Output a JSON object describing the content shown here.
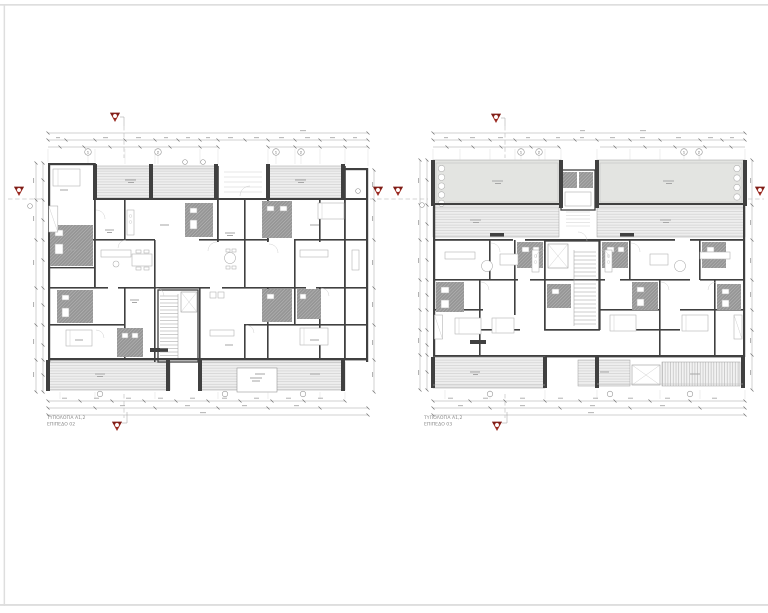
{
  "sheet": {
    "background_color": "#ffffff",
    "border_color": "#dedede"
  },
  "drawing": {
    "type": "architectural-floor-plans",
    "colors": {
      "wall": "#404040",
      "line_light": "#9c9c9c",
      "wet_area_fill": "#969696",
      "balcony_fill": "#eeeeee",
      "terrace_fill": "#e3e4e1",
      "section_marker_red": "#9b2b22"
    },
    "plans": [
      {
        "title": "ΤΥΠΟΛΟΓΙΑ A1,2",
        "level": "ΕΠΙΠΕΔΟ 02",
        "grid_bubbles": [
          "1",
          "2",
          "1",
          "2"
        ]
      },
      {
        "title": "ΤΥΠΟΛΟΓΙΑ A1,2",
        "level": "ΕΠΙΠΕΔΟ 03",
        "grid_bubbles": [
          "1",
          "2",
          "1",
          "2"
        ]
      }
    ]
  }
}
